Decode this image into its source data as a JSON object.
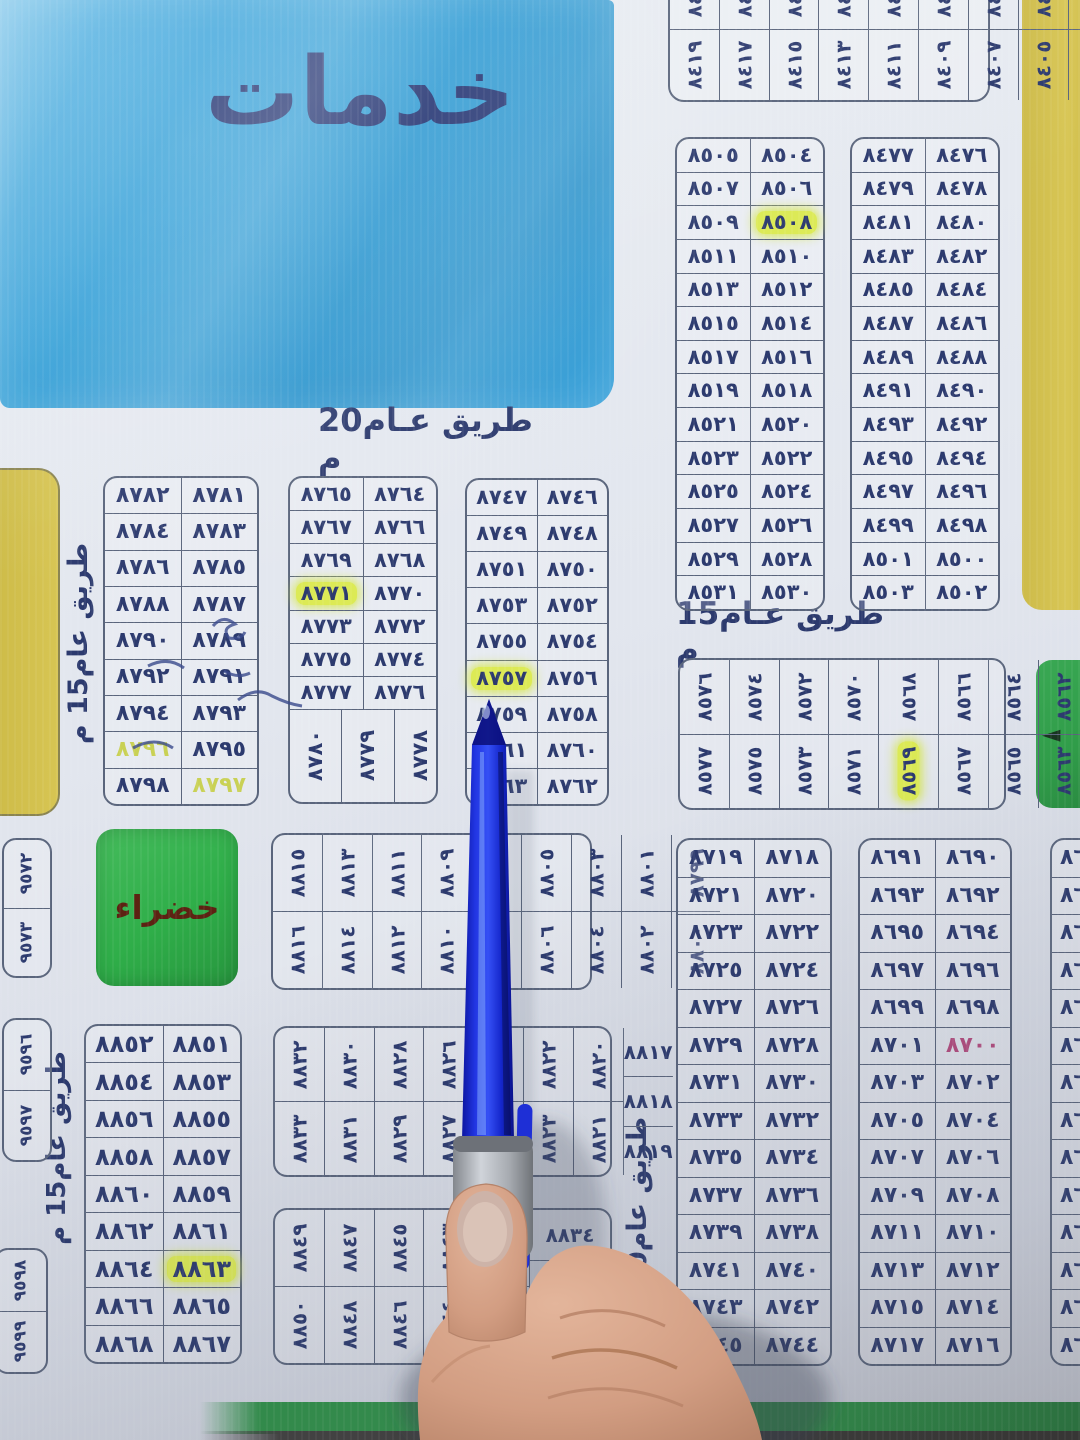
{
  "areas": {
    "services": "خدمات",
    "green": "خضراء"
  },
  "roads": {
    "top": "طريق عـام20 م",
    "mid_right": "طريق عـام15 م",
    "left_upper": "طريق عام15 م",
    "left_lower": "طريق عام15 م",
    "bottom_vertical": "طريق عام20 م"
  },
  "arrow_icon": "◄",
  "colors": {
    "board": "#e3e7ee",
    "services_blue": "#2f9dd6",
    "area_yellow": "#d5c34e",
    "area_green": "#2fae49",
    "arrow_green": "#2f9e48",
    "ink_navy": "#2c3a6e",
    "highlight": "#dcea55",
    "red_ink": "#b34b7e",
    "yellow_ink": "#c9d155",
    "pen_blue": "#1e2fd6",
    "pen_grip_gray": "#9aa0a6",
    "band_green": "#2d9245"
  },
  "marks": {
    "٨٥٠٨": "hl",
    "٨٥٦٩": "hl",
    "٨٧٧١": "hl",
    "٨٧٥٧": "hl",
    "٨٨٦٣": "hl",
    "٨٧٩٦": "ytxt",
    "٨٧٩٧": "ytxt",
    "٨٧٠٠": "red"
  },
  "tables": {
    "t84rot": {
      "type": "rot",
      "cols": [
        [
          "٨٤١٨",
          "٨٤١٩"
        ],
        [
          "٨٤١٦",
          "٨٤١٧"
        ],
        [
          "٨٤١٤",
          "٨٤١٥"
        ],
        [
          "٨٤١٢",
          "٨٤١٣"
        ],
        [
          "٨٤١٠",
          "٨٤١١"
        ],
        [
          "٨٤٠٨",
          "٨٤٠٩"
        ],
        [
          "٨٤٠٦",
          "٨٤٠٧"
        ],
        [
          "٨٤٠٤",
          "٨٤٠٥"
        ],
        [
          "٨٤٠٢",
          "٨٤٠٣"
        ]
      ]
    },
    "t85a": {
      "type": "grid",
      "rows": [
        [
          "٨٥٠٥",
          "٨٥٠٤"
        ],
        [
          "٨٥٠٧",
          "٨٥٠٦"
        ],
        [
          "٨٥٠٩",
          "٨٥٠٨"
        ],
        [
          "٨٥١١",
          "٨٥١٠"
        ],
        [
          "٨٥١٣",
          "٨٥١٢"
        ],
        [
          "٨٥١٥",
          "٨٥١٤"
        ],
        [
          "٨٥١٧",
          "٨٥١٦"
        ],
        [
          "٨٥١٩",
          "٨٥١٨"
        ],
        [
          "٨٥٢١",
          "٨٥٢٠"
        ],
        [
          "٨٥٢٣",
          "٨٥٢٢"
        ],
        [
          "٨٥٢٥",
          "٨٥٢٤"
        ],
        [
          "٨٥٢٧",
          "٨٥٢٦"
        ],
        [
          "٨٥٢٩",
          "٨٥٢٨"
        ],
        [
          "٨٥٣١",
          "٨٥٣٠"
        ]
      ]
    },
    "t84a": {
      "type": "grid",
      "rows": [
        [
          "٨٤٧٧",
          "٨٤٧٦"
        ],
        [
          "٨٤٧٩",
          "٨٤٧٨"
        ],
        [
          "٨٤٨١",
          "٨٤٨٠"
        ],
        [
          "٨٤٨٣",
          "٨٤٨٢"
        ],
        [
          "٨٤٨٥",
          "٨٤٨٤"
        ],
        [
          "٨٤٨٧",
          "٨٤٨٦"
        ],
        [
          "٨٤٨٩",
          "٨٤٨٨"
        ],
        [
          "٨٤٩١",
          "٨٤٩٠"
        ],
        [
          "٨٤٩٣",
          "٨٤٩٢"
        ],
        [
          "٨٤٩٥",
          "٨٤٩٤"
        ],
        [
          "٨٤٩٧",
          "٨٤٩٦"
        ],
        [
          "٨٤٩٩",
          "٨٤٩٨"
        ],
        [
          "٨٥٠١",
          "٨٥٠٠"
        ],
        [
          "٨٥٠٣",
          "٨٥٠٢"
        ]
      ]
    },
    "t85rot": {
      "type": "rot",
      "cols": [
        [
          "٨٥٧٦",
          "٨٥٧٧"
        ],
        [
          "٨٥٧٤",
          "٨٥٧٥"
        ],
        [
          "٨٥٧٢",
          "٨٥٧٣"
        ],
        [
          "٨٥٧٠",
          "٨٥٧١"
        ],
        [
          "٨٥٦٨",
          "٨٥٦٩"
        ],
        [
          "٨٥٦٦",
          "٨٥٦٧"
        ],
        [
          "٨٥٦٤",
          "٨٥٦٥"
        ],
        [
          "٨٥٦٢",
          "٨٥٦٣"
        ],
        [
          "٨٥٦٠",
          "٨٥٦١"
        ]
      ]
    },
    "t878": {
      "type": "grid",
      "rows": [
        [
          "٨٧٨٢",
          "٨٧٨١"
        ],
        [
          "٨٧٨٤",
          "٨٧٨٣"
        ],
        [
          "٨٧٨٦",
          "٨٧٨٥"
        ],
        [
          "٨٧٨٨",
          "٨٧٨٧"
        ],
        [
          "٨٧٩٠",
          "٨٧٨٩"
        ],
        [
          "٨٧٩٢",
          "٨٧٩١"
        ],
        [
          "٨٧٩٤",
          "٨٧٩٣"
        ],
        [
          "٨٧٩٦",
          "٨٧٩٥"
        ],
        [
          "٨٧٩٨",
          "٨٧٩٧"
        ]
      ]
    },
    "t877": {
      "type": "grid",
      "rows": [
        [
          "٨٧٦٥",
          "٨٧٦٤"
        ],
        [
          "٨٧٦٧",
          "٨٧٦٦"
        ],
        [
          "٨٧٦٩",
          "٨٧٦٨"
        ],
        [
          "٨٧٧١",
          "٨٧٧٠"
        ],
        [
          "٨٧٧٣",
          "٨٧٧٢"
        ],
        [
          "٨٧٧٥",
          "٨٧٧٤"
        ],
        [
          "٨٧٧٧",
          "٨٧٧٦"
        ]
      ],
      "bottom_rot": [
        "٨٧٨٠",
        "٨٧٧٩",
        "٨٧٧٨"
      ]
    },
    "t875": {
      "type": "grid",
      "rows": [
        [
          "٨٧٤٧",
          "٨٧٤٦"
        ],
        [
          "٨٧٤٩",
          "٨٧٤٨"
        ],
        [
          "٨٧٥١",
          "٨٧٥٠"
        ],
        [
          "٨٧٥٣",
          "٨٧٥٢"
        ],
        [
          "٨٧٥٥",
          "٨٧٥٤"
        ],
        [
          "٨٧٥٧",
          "٨٧٥٦"
        ],
        [
          "٨٧٥٩",
          "٨٧٥٨"
        ],
        [
          "٨٧٦١",
          "٨٧٦٠"
        ],
        [
          "٨٧٦٣",
          "٨٧٦٢"
        ]
      ]
    },
    "t88rot": {
      "type": "rot",
      "cols": [
        [
          "٨٨١٥",
          "٨٨١٦"
        ],
        [
          "٨٨١٣",
          "٨٨١٤"
        ],
        [
          "٨٨١١",
          "٨٨١٢"
        ],
        [
          "٨٨٠٩",
          "٨٨١٠"
        ],
        [
          "٨٨٠٧",
          "٨٨٠٨"
        ],
        [
          "٨٨٠٥",
          "٨٨٠٦"
        ],
        [
          "٨٨٠٣",
          "٨٨٠٤"
        ],
        [
          "٨٨٠١",
          "٨٨٠٢"
        ],
        [
          "٨٧٩٩",
          "٨٨٠٠"
        ]
      ]
    },
    "t9572": {
      "type": "stack",
      "values": [
        "٩٥٧٢",
        "٩٥٧٣"
      ]
    },
    "t9596": {
      "type": "stack",
      "values": [
        "٩٥٩٦",
        "٩٥٩٧"
      ]
    },
    "t9598": {
      "type": "stack",
      "values": [
        "٩٥٩٨",
        "٩٥٩٩"
      ]
    },
    "t885": {
      "type": "grid",
      "rows": [
        [
          "٨٨٥٢",
          "٨٨٥١"
        ],
        [
          "٨٨٥٤",
          "٨٨٥٣"
        ],
        [
          "٨٨٥٦",
          "٨٨٥٥"
        ],
        [
          "٨٨٥٨",
          "٨٨٥٧"
        ],
        [
          "٨٨٦٠",
          "٨٨٥٩"
        ],
        [
          "٨٨٦٢",
          "٨٨٦١"
        ],
        [
          "٨٨٦٤",
          "٨٨٦٣"
        ],
        [
          "٨٨٦٦",
          "٨٨٦٥"
        ],
        [
          "٨٨٦٨",
          "٨٨٦٧"
        ]
      ]
    },
    "t882rot": {
      "type": "rot",
      "cols": [
        [
          "٨٨٣٢",
          "٨٨٣٣"
        ],
        [
          "٨٨٣٠",
          "٨٨٣١"
        ],
        [
          "٨٨٢٨",
          "٨٨٢٩"
        ],
        [
          "٨٨٢٦",
          "٨٨٢٧"
        ],
        [
          "٨٨٢٤",
          "٨٨٢٥"
        ],
        [
          "٨٨٢٢",
          "٨٨٢٣"
        ],
        [
          "٨٨٢٠",
          "٨٨٢١"
        ]
      ],
      "side": [
        "٨٨١٧",
        "٨٨١٨",
        "٨٨١٩"
      ]
    },
    "t884rot": {
      "type": "rot",
      "cols": [
        [
          "٨٨٤٩",
          "٨٨٥٠"
        ],
        [
          "٨٨٤٧",
          "٨٨٤٨"
        ],
        [
          "٨٨٤٥",
          "٨٨٤٦"
        ],
        [
          "٨٨٤٣",
          "٨٨٤٤"
        ],
        [
          "٨٨٤١",
          "٨٨٤٢"
        ],
        [
          "",
          ""
        ],
        [
          "",
          ""
        ]
      ],
      "side": [
        "٨٨٣٤",
        "",
        ""
      ]
    },
    "t87a": {
      "type": "grid",
      "rows": [
        [
          "٨٧١٩",
          "٨٧١٨"
        ],
        [
          "٨٧٢١",
          "٨٧٢٠"
        ],
        [
          "٨٧٢٣",
          "٨٧٢٢"
        ],
        [
          "٨٧٢٥",
          "٨٧٢٤"
        ],
        [
          "٨٧٢٧",
          "٨٧٢٦"
        ],
        [
          "٨٧٢٩",
          "٨٧٢٨"
        ],
        [
          "٨٧٣١",
          "٨٧٣٠"
        ],
        [
          "٨٧٣٣",
          "٨٧٣٢"
        ],
        [
          "٨٧٣٥",
          "٨٧٣٤"
        ],
        [
          "٨٧٣٧",
          "٨٧٣٦"
        ],
        [
          "٨٧٣٩",
          "٨٧٣٨"
        ],
        [
          "٨٧٤١",
          "٨٧٤٠"
        ],
        [
          "٨٧٤٣",
          "٨٧٤٢"
        ],
        [
          "٨٧٤٥",
          "٨٧٤٤"
        ]
      ]
    },
    "t87b": {
      "type": "grid",
      "rows": [
        [
          "٨٦٩١",
          "٨٦٩٠"
        ],
        [
          "٨٦٩٣",
          "٨٦٩٢"
        ],
        [
          "٨٦٩٥",
          "٨٦٩٤"
        ],
        [
          "٨٦٩٧",
          "٨٦٩٦"
        ],
        [
          "٨٦٩٩",
          "٨٦٩٨"
        ],
        [
          "٨٧٠١",
          "٨٧٠٠"
        ],
        [
          "٨٧٠٣",
          "٨٧٠٢"
        ],
        [
          "٨٧٠٥",
          "٨٧٠٤"
        ],
        [
          "٨٧٠٧",
          "٨٧٠٦"
        ],
        [
          "٨٧٠٩",
          "٨٧٠٨"
        ],
        [
          "٨٧١١",
          "٨٧١٠"
        ],
        [
          "٨٧١٣",
          "٨٧١٢"
        ],
        [
          "٨٧١٥",
          "٨٧١٤"
        ],
        [
          "٨٧١٧",
          "٨٧١٦"
        ]
      ]
    },
    "t86p": {
      "type": "plist",
      "rows": [
        "٨٦",
        "٨٦",
        "٨٦",
        "٨٦",
        "٨٦",
        "٨٦",
        "٨٦",
        "٨٦",
        "٨٦",
        "٨٦",
        "٨٦",
        "٨٦",
        "٨٦",
        "٨٦"
      ]
    }
  }
}
